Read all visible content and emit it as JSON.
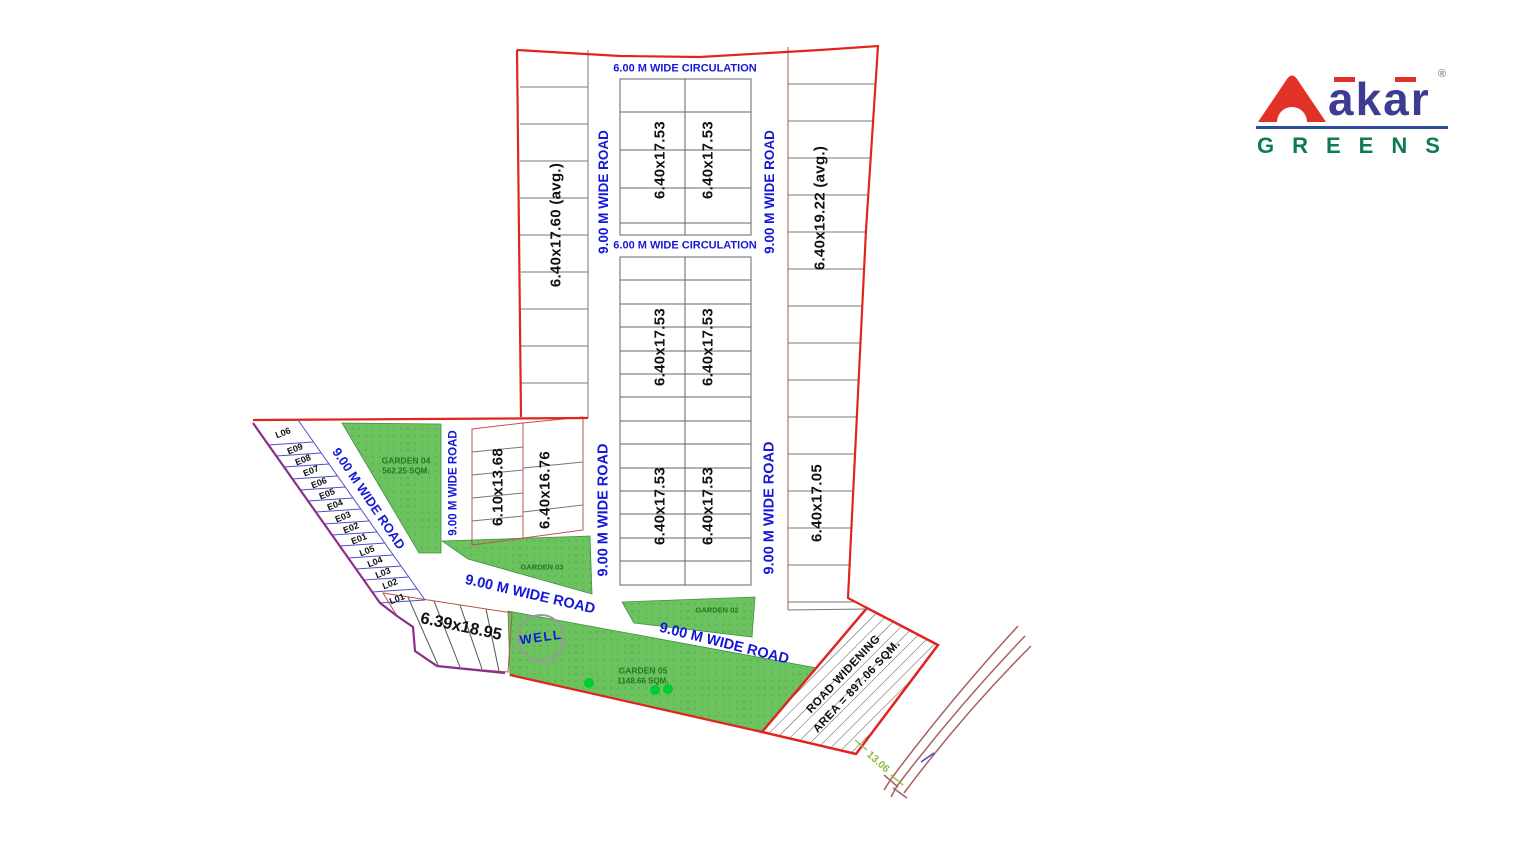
{
  "logo": {
    "brand": "akar",
    "registered": "®",
    "subtitle": "GREENS"
  },
  "plan": {
    "road_labels": {
      "wide_road": "9.00 M WIDE ROAD",
      "circulation": "6.00 M WIDE CIRCULATION"
    },
    "plot_dims": {
      "left_column": "6.40x17.60 (avg.)",
      "central": "6.40x17.53",
      "right_column_top": "6.40x19.22 (avg.)",
      "right_column_bottom": "6.40x17.05",
      "block_a": "6.10x13.68",
      "block_b": "6.40x16.76",
      "block_c": "6.39x18.95"
    },
    "gardens": {
      "g04": {
        "name": "GARDEN 04",
        "area": "562.25 SQM."
      },
      "g03": {
        "name": "GARDEN 03"
      },
      "g02": {
        "name": "GARDEN 02"
      },
      "g05": {
        "name": "GARDEN 05",
        "area": "1148.66 SQM."
      }
    },
    "well": "WELL",
    "road_widening": {
      "line1": "ROAD WIDENING",
      "line2": "AREA = 897.06 SQM."
    },
    "dimension_13": "13.06",
    "strip_plots": [
      "L06",
      "E09",
      "E08",
      "E07",
      "E06",
      "E05",
      "E04",
      "E03",
      "E02",
      "E01",
      "L05",
      "L04",
      "L03",
      "L02",
      "L01"
    ]
  },
  "colors": {
    "boundary": "#e0251f",
    "purple": "#8b2f8b",
    "roadtext": "#1518d8",
    "gardenfill": "#6cc25f",
    "gardentext": "#1c7a1e",
    "dimgreen": "#8fb943",
    "logonavy": "#3c3c92",
    "logored": "#e23127",
    "logoline": "#2b4d9b",
    "logogreen": "#0e7c52"
  }
}
